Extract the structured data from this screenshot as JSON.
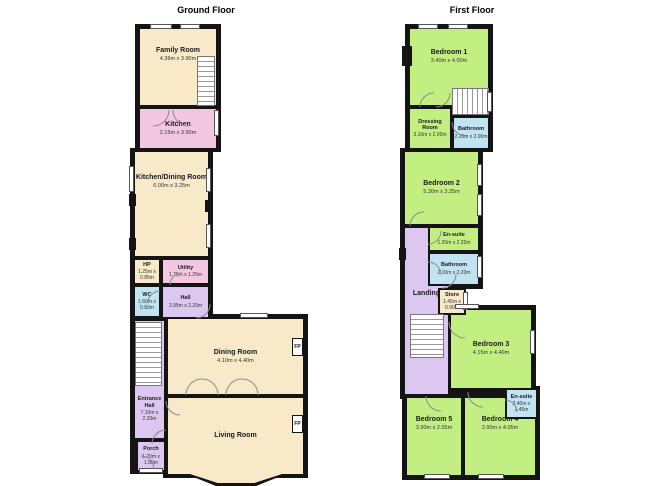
{
  "ground_floor": {
    "title": "Ground Floor",
    "fireplace_label": "FP",
    "rooms": {
      "family_room": {
        "name": "Family Room",
        "dims": "4.36m x 3.90m"
      },
      "kitchen": {
        "name": "Kitchen",
        "dims": "2.15m x 3.90m"
      },
      "kitchen_dining": {
        "name": "Kitchen/Dining Room",
        "dims": "6.00m x 3.25m"
      },
      "hp": {
        "name": "HP",
        "dims": "1.25m x 0.85m"
      },
      "utility": {
        "name": "Utility",
        "dims": "1.75m x 1.25m"
      },
      "wc": {
        "name": "WC",
        "dims": "1.60m x 0.80m"
      },
      "hall": {
        "name": "Hall",
        "dims": "2.95m x 2.20m"
      },
      "dining_room": {
        "name": "Dining Room",
        "dims": "4.10m x 4.40m"
      },
      "entrance_hall": {
        "name": "Entrance Hall",
        "dims": "7.10m x 2.20m"
      },
      "living_room": {
        "name": "Living Room",
        "dims": ""
      },
      "porch": {
        "name": "Porch",
        "dims": "1.20m x 1.80m"
      }
    }
  },
  "first_floor": {
    "title": "First Floor",
    "rooms": {
      "bedroom1": {
        "name": "Bedroom 1",
        "dims": "3.40m x 4.00m"
      },
      "dressing_room": {
        "name": "Dressing Room",
        "dims": "3.10m x 2.00m"
      },
      "bathroom_top": {
        "name": "Bathroom",
        "dims": "2.20m x 2.00m"
      },
      "bedroom2": {
        "name": "Bedroom 2",
        "dims": "5.30m x 3.25m"
      },
      "ensuite_mid": {
        "name": "En-suite",
        "dims": "1.20m x 2.20m"
      },
      "bathroom_mid": {
        "name": "Bathroom",
        "dims": "2.10m x 2.20m"
      },
      "landing": {
        "name": "Landing",
        "dims": ""
      },
      "store": {
        "name": "Store",
        "dims": "1.45m x 0.90m"
      },
      "bedroom3": {
        "name": "Bedroom 3",
        "dims": "4.15m x 4.40m"
      },
      "ensuite_bottom": {
        "name": "En-suite",
        "dims": "2.40m x 1.45m"
      },
      "bedroom5": {
        "name": "Bedroom 5",
        "dims": "3.90m x 2.55m"
      },
      "bedroom4": {
        "name": "Bedroom 4",
        "dims": "3.90m x 4.05m"
      }
    }
  },
  "colors": {
    "wall": "#141414",
    "room_cream": "#f8e9c8",
    "room_pink": "#f3c6e2",
    "room_blue": "#c2e3f2",
    "room_lavender": "#dcc7f0",
    "room_green": "#c3ef82"
  }
}
